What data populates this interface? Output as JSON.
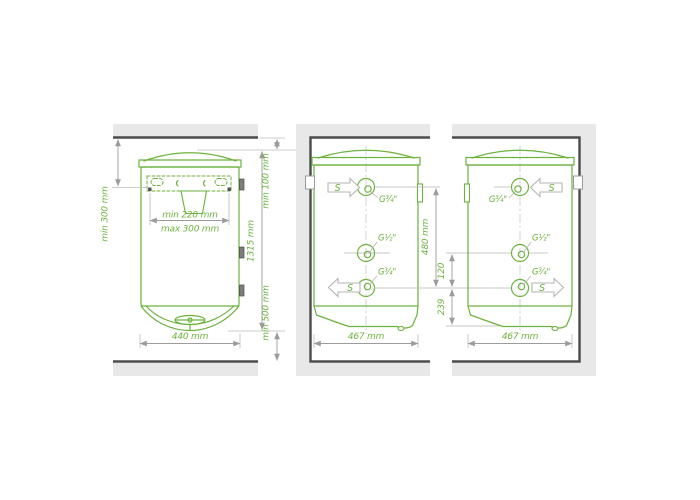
{
  "colors": {
    "outline_green": "#6cb23e",
    "dim_line_gray": "#9c9c9c",
    "wall_fill": "#e8e8e8",
    "wall_edge": "#4b4b4b"
  },
  "front_view": {
    "side_offset": "min 300 mm",
    "bracket_spacing_min": "min 220 mm",
    "bracket_spacing_max": "max 300 mm",
    "top_clearance": "min 100 mm",
    "total_height": "1315 mm",
    "bottom_clearance": "min 500 mm",
    "width": "440 mm"
  },
  "side_view_left": {
    "width": "467 mm",
    "inlet_label": "S",
    "outlet_label": "S",
    "connections": {
      "top": "G¾\"",
      "middle": "G½\"",
      "bottom": "G¾\""
    }
  },
  "side_view_right": {
    "width": "467 mm",
    "inlet_label": "S",
    "outlet_label": "S",
    "connections": {
      "top": "G¾\"",
      "middle": "G½\"",
      "bottom": "G¾\""
    }
  },
  "spacing": {
    "connection_span": "480 mm",
    "middle_to_bottom": "120",
    "bottom_connection_offset": "239"
  }
}
